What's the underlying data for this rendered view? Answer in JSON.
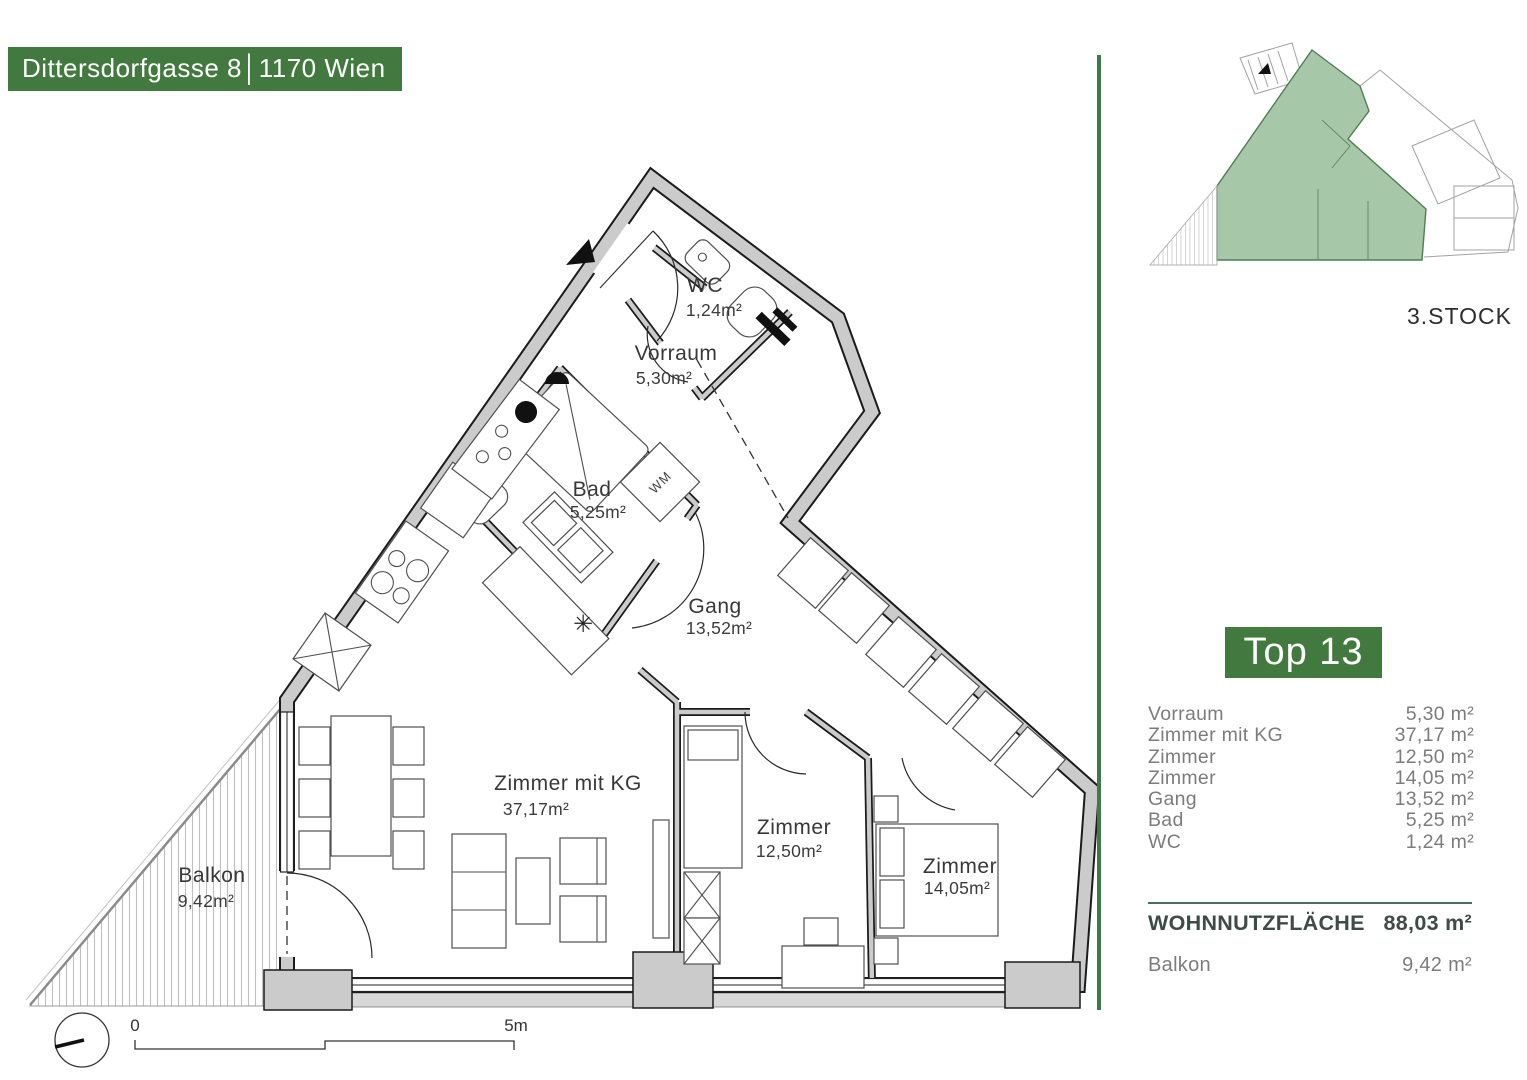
{
  "header": {
    "title": "Dittersdorfgasse 8│1170 Wien"
  },
  "overview": {
    "floor_label": "3.STOCK"
  },
  "unit": {
    "title": "Top 13"
  },
  "rooms_list": [
    {
      "label": "Vorraum",
      "area": "5,30 m²"
    },
    {
      "label": "Zimmer mit KG",
      "area": "37,17 m²"
    },
    {
      "label": "Zimmer",
      "area": "12,50 m²"
    },
    {
      "label": "Zimmer",
      "area": "14,05 m²"
    },
    {
      "label": "Gang",
      "area": "13,52 m²"
    },
    {
      "label": "Bad",
      "area": "5,25 m²"
    },
    {
      "label": "WC",
      "area": "1,24 m²"
    }
  ],
  "summary": {
    "label": "WOHNNUTZFLÄCHE",
    "value": "88,03 m²"
  },
  "balcony_row": {
    "label": "Balkon",
    "value": "9,42 m²"
  },
  "plan": {
    "wc": {
      "name": "WC",
      "area": "1,24m²"
    },
    "vorraum": {
      "name": "Vorraum",
      "area": "5,30m²"
    },
    "bad": {
      "name": "Bad",
      "area": "5,25m²"
    },
    "gang": {
      "name": "Gang",
      "area": "13,52m²"
    },
    "zimmer_kg": {
      "name": "Zimmer mit KG",
      "area": "37,17m²"
    },
    "zimmer_2": {
      "name": "Zimmer",
      "area": "12,50m²"
    },
    "zimmer_3": {
      "name": "Zimmer",
      "area": "14,05m²"
    },
    "balkon": {
      "name": "Balkon",
      "area": "9,42m²"
    },
    "wm_label": "WM",
    "dishwasher_icon": "✳"
  },
  "scale_bar": {
    "start": "0",
    "end": "5m"
  },
  "colors": {
    "brand_green": "#42793f",
    "divider_green": "#3f7a4b",
    "unit_highlight": "#a6c7a8",
    "text_gray": "#7c7c7c",
    "summary_dark": "#3f4b47",
    "line_green": "#47705a"
  }
}
